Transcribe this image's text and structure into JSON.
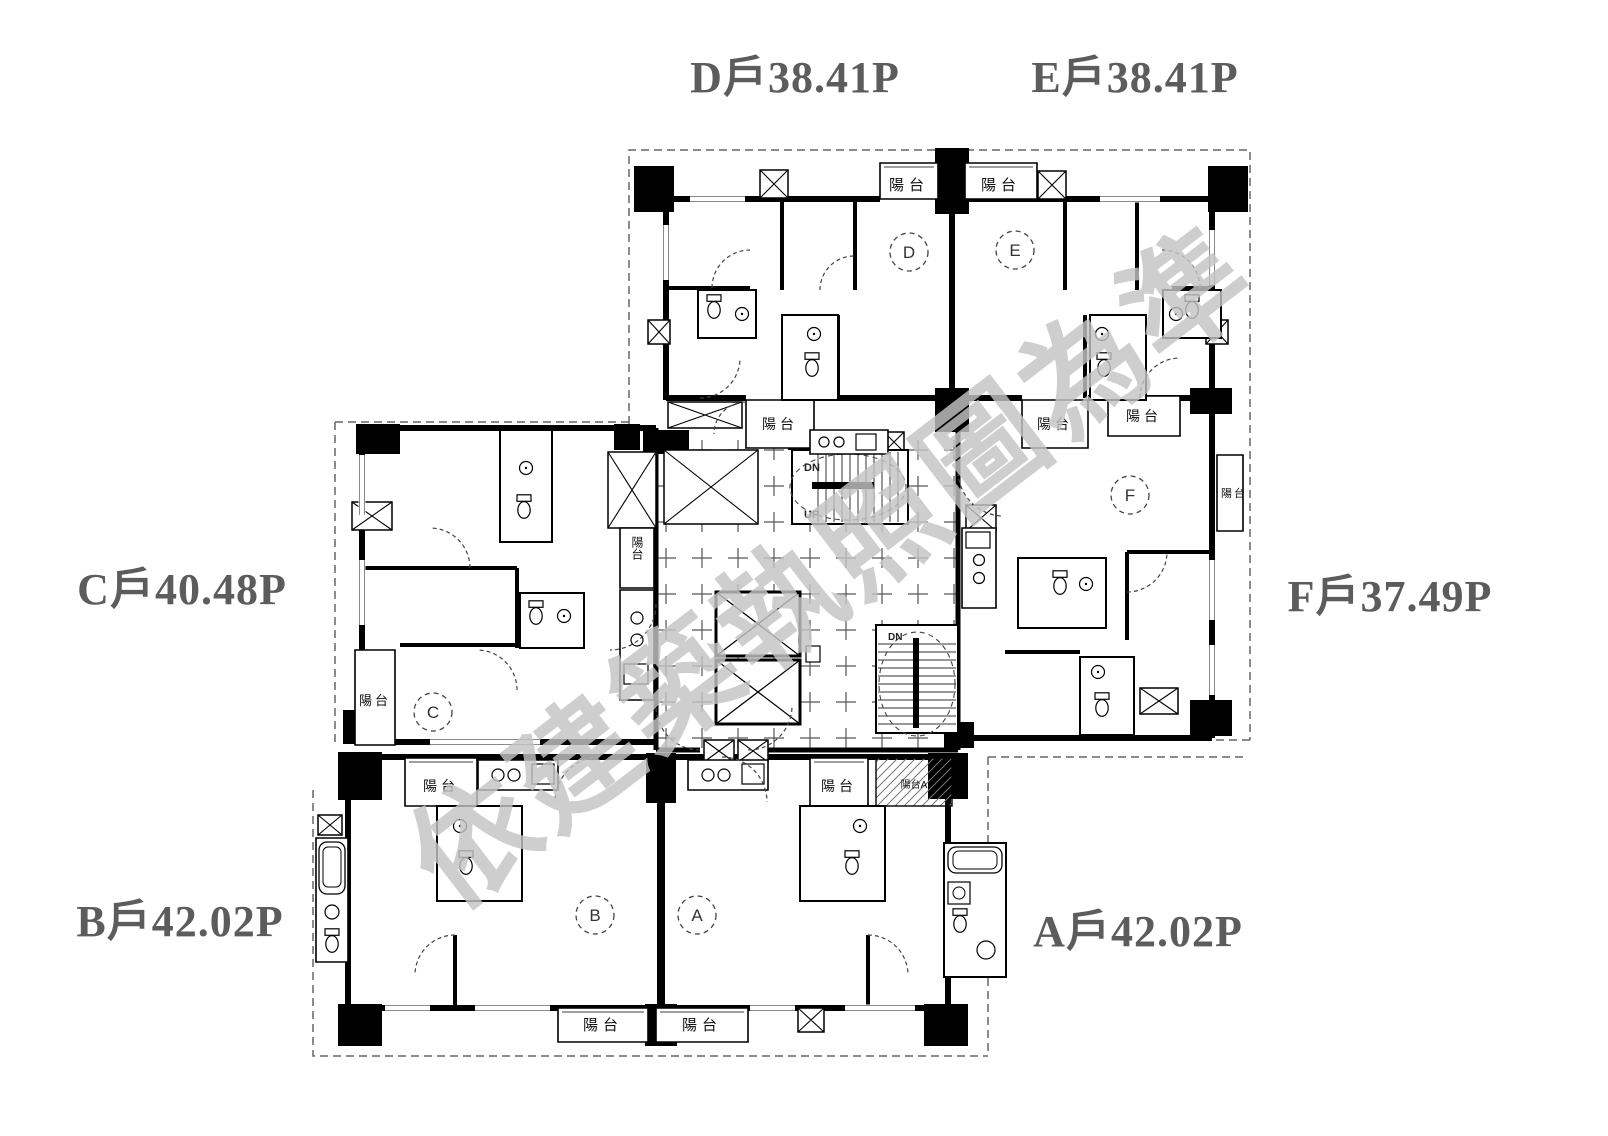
{
  "units": [
    {
      "id": "D",
      "letter": "D",
      "area_label": "D戶38.41P"
    },
    {
      "id": "E",
      "letter": "E",
      "area_label": "E戶38.41P"
    },
    {
      "id": "C",
      "letter": "C",
      "area_label": "C戶40.48P"
    },
    {
      "id": "F",
      "letter": "F",
      "area_label": "F戶37.49P"
    },
    {
      "id": "B",
      "letter": "B",
      "area_label": "B戶42.02P"
    },
    {
      "id": "A",
      "letter": "A",
      "area_label": "A戶42.02P"
    }
  ],
  "plan_labels": {
    "balcony": "陽台",
    "balcony_a": "陽台A",
    "up": "UP",
    "dn": "DN"
  },
  "watermark": {
    "text": "依建築執照圖為準"
  },
  "colors": {
    "wall": "#000000",
    "unit_label": "#5c5c5c",
    "dash": "#666666",
    "watermark": "#c3c3c3"
  }
}
